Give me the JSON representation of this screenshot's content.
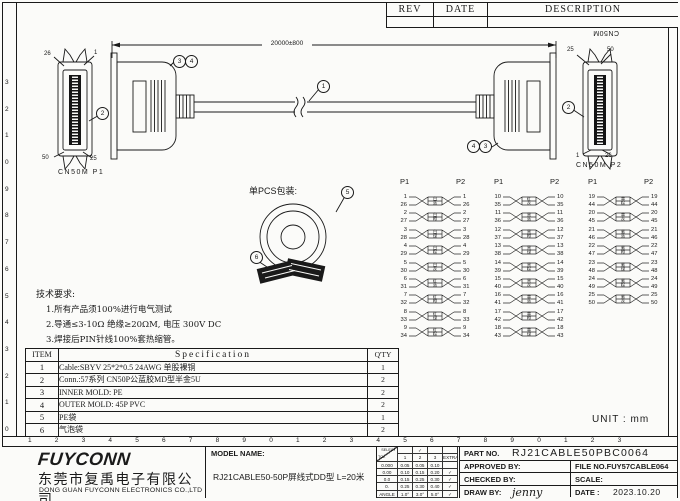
{
  "rev_table": {
    "rev": "REV",
    "date": "DATE",
    "description": "DESCRIPTION"
  },
  "drawing": {
    "dimension_label": "20000±800",
    "cable_callout": "1",
    "connector_callout": "2",
    "mold_callouts": [
      "3",
      "4"
    ],
    "p1": {
      "name": "CN50M  P1",
      "top_left": "26",
      "top_right": "1",
      "bottom_left": "50",
      "bottom_right": "25"
    },
    "p2": {
      "name": "CN50M  P2",
      "rotated": "CN50M",
      "top_left": "25",
      "top_right": "50",
      "bottom_left": "1",
      "bottom_right": "26"
    }
  },
  "packaging": {
    "label": "单PCS包装:",
    "bag_callout": "5",
    "conn_callout": "6"
  },
  "pin_map": {
    "columns": [
      {
        "left": "P1",
        "right": "P2",
        "pairs": [
          {
            "a": "1",
            "b": "26",
            "c1": "白",
            "c2": "蓝"
          },
          {
            "a": "2",
            "b": "27",
            "c1": "白",
            "c2": "橙"
          },
          {
            "a": "3",
            "b": "28",
            "c1": "白",
            "c2": "绿"
          },
          {
            "a": "4",
            "b": "29",
            "c1": "白",
            "c2": "棕"
          },
          {
            "a": "5",
            "b": "30",
            "c1": "白",
            "c2": "灰"
          },
          {
            "a": "6",
            "b": "31",
            "c1": "红",
            "c2": "蓝"
          },
          {
            "a": "7",
            "b": "32",
            "c1": "红",
            "c2": "橙"
          },
          {
            "a": "8",
            "b": "33",
            "c1": "红",
            "c2": "绿"
          },
          {
            "a": "9",
            "b": "34",
            "c1": "红",
            "c2": "棕"
          }
        ]
      },
      {
        "left": "P1",
        "right": "P2",
        "pairs": [
          {
            "a": "10",
            "b": "35",
            "c1": "红",
            "c2": "灰"
          },
          {
            "a": "11",
            "b": "36",
            "c1": "黑",
            "c2": "蓝"
          },
          {
            "a": "12",
            "b": "37",
            "c1": "黑",
            "c2": "橙"
          },
          {
            "a": "13",
            "b": "38",
            "c1": "黑",
            "c2": "绿"
          },
          {
            "a": "14",
            "b": "39",
            "c1": "黑",
            "c2": "棕"
          },
          {
            "a": "15",
            "b": "40",
            "c1": "黑",
            "c2": "灰"
          },
          {
            "a": "16",
            "b": "41",
            "c1": "黄",
            "c2": "蓝"
          },
          {
            "a": "17",
            "b": "42",
            "c1": "黄",
            "c2": "橙"
          },
          {
            "a": "18",
            "b": "43",
            "c1": "黄",
            "c2": "绿"
          }
        ]
      },
      {
        "left": "P1",
        "right": "P2",
        "pairs": [
          {
            "a": "19",
            "b": "44",
            "c1": "黄",
            "c2": "棕"
          },
          {
            "a": "20",
            "b": "45",
            "c1": "黄",
            "c2": "灰"
          },
          {
            "a": "21",
            "b": "46",
            "c1": "紫",
            "c2": "蓝"
          },
          {
            "a": "22",
            "b": "47",
            "c1": "紫",
            "c2": "橙"
          },
          {
            "a": "23",
            "b": "48",
            "c1": "紫",
            "c2": "绿"
          },
          {
            "a": "24",
            "b": "49",
            "c1": "紫",
            "c2": "棕"
          },
          {
            "a": "25",
            "b": "50",
            "c1": "紫",
            "c2": "灰"
          }
        ]
      }
    ]
  },
  "tech_requirements": {
    "title": "技术要求:",
    "items": [
      "1.所有产品须100%进行电气测试",
      "2.导通≤3-10Ω  绝缘≥20ΩM, 电压 300V DC",
      "3.焊接后PIN针线100%套热缩管。"
    ]
  },
  "spec_table": {
    "headers": [
      "ITEM",
      "Specification",
      "Q'TY"
    ],
    "rows": [
      [
        "1",
        "Cable:SBYV 25*2*0.5 24AWG 单股裸铜",
        "1"
      ],
      [
        "2",
        "Conn.:57系列  CN50P公蓝胶MD型半金5U",
        "2"
      ],
      [
        "3",
        "INNER MOLD: PE",
        "2"
      ],
      [
        "4",
        "OUTER MOLD: 45P PVC",
        "2"
      ],
      [
        "5",
        "PE袋",
        "1"
      ],
      [
        "6",
        "气泡袋",
        "2"
      ]
    ]
  },
  "unit_label": "UNIT : mm",
  "title_block": {
    "logo": "FUYCONN",
    "company_cn": "东莞市复禹电子有限公司",
    "company_en": "DONG GUAN FUYCONN ELECTRONICS CO.,LTD",
    "model_label": "MODEL NAME:",
    "model_value": "RJ21CABLE50-50P屏线式DD型  L=20米",
    "tolerance": {
      "select_label": "SELECT",
      "tol_label": "TOL",
      "check": "✓",
      "col_headers": [
        "1",
        "2",
        "3",
        "EXTRA"
      ],
      "rows": [
        {
          "label": "0.000",
          "v": [
            "0.05",
            "0.05",
            "0.10"
          ],
          "extra": ""
        },
        {
          "label": "0.00",
          "v": [
            "0.10",
            "0.15",
            "0.20"
          ],
          "extra": "✓"
        },
        {
          "label": "0.0",
          "v": [
            "0.15",
            "0.25",
            "0.30"
          ],
          "extra": "✓"
        },
        {
          "label": "0.",
          "v": [
            "0.25",
            "0.30",
            "0.40"
          ],
          "extra": "✓"
        },
        {
          "label": "ANGLE",
          "v": [
            "1.0°",
            "3.0°",
            "5.0°"
          ],
          "extra": "✓"
        }
      ]
    },
    "part_no_label": "PART NO.",
    "part_no": "RJ21CABLE50PBC0064",
    "approved_label": "APPROVED BY:",
    "file_no_label": "FILE NO.",
    "file_no": "FUY57CABLE064",
    "checked_label": "CHECKED BY:",
    "scale_label": "SCALE:",
    "draw_label": "DRAW BY:",
    "draw_by": "jenny",
    "date_label": "DATE :",
    "date": "2023.10.20"
  },
  "rulers": {
    "bottom": [
      "1",
      "2",
      "3",
      "4",
      "5",
      "6",
      "7",
      "8",
      "9",
      "0",
      "1",
      "2",
      "3",
      "4",
      "5",
      "6",
      "7",
      "8",
      "9",
      "0",
      "1",
      "2",
      "3"
    ],
    "left": [
      "0",
      "1",
      "2",
      "3",
      "4",
      "5",
      "6",
      "7",
      "8",
      "9",
      "0",
      "1",
      "2",
      "3"
    ]
  }
}
